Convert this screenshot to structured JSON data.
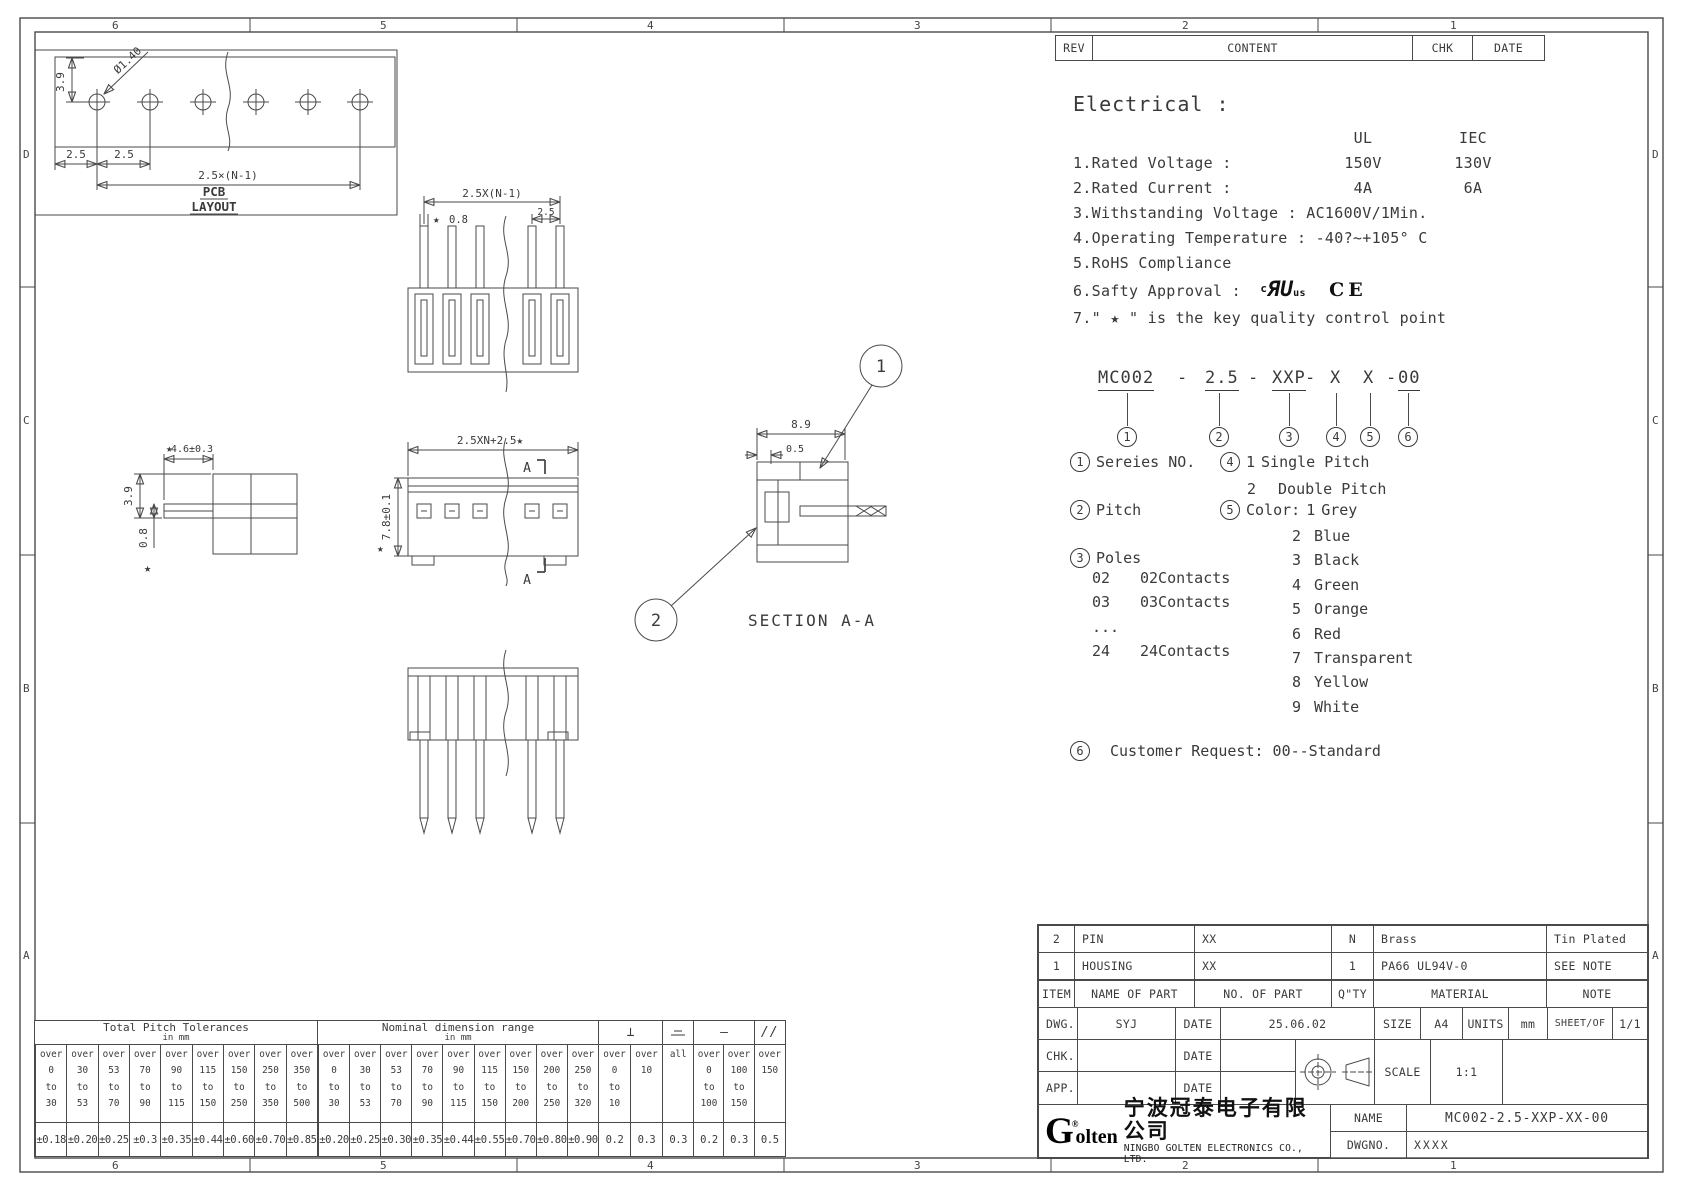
{
  "frame": {
    "zone_cols": [
      "6",
      "5",
      "4",
      "3",
      "2",
      "1"
    ],
    "zone_rows": [
      "D",
      "C",
      "B",
      "A"
    ]
  },
  "rev_table": {
    "rev": "REV",
    "content": "CONTENT",
    "chk": "CHK",
    "date": "DATE"
  },
  "electrical": {
    "heading": "Electrical :",
    "ul": "UL",
    "iec": "IEC",
    "row1_label": "1.Rated Voltage :",
    "row1_ul": "150V",
    "row1_iec": "130V",
    "row2_label": "2.Rated Current :",
    "row2_ul": "4A",
    "row2_iec": "6A",
    "line3": "3.Withstanding Voltage : AC1600V/1Min.",
    "line4": "4.Operating Temperature : -40?~+105° C",
    "line5": "5.RoHS Compliance",
    "line6": "6.Safty Approval :",
    "ul_c": "c",
    "ul_ru": "ЯU",
    "ul_us": "us",
    "ce": "CE",
    "line7": "7.\" ★ \" is the key quality control point"
  },
  "part_number": {
    "p1": "MC002",
    "d1": "-",
    "p2": "2.5",
    "d2": "-",
    "p3": "XXP",
    "d3": "-",
    "p4": "X",
    "p5": "X",
    "d4": "-",
    "p6": "00",
    "circles": [
      "1",
      "2",
      "3",
      "4",
      "5",
      "6"
    ]
  },
  "legend": {
    "series_num": "1",
    "series_label": "Sereies NO.",
    "pitch_num": "2",
    "pitch_label": "Pitch",
    "poles_num": "3",
    "poles_label": "Poles",
    "poles_rows": [
      {
        "code": "02",
        "desc": "02Contacts"
      },
      {
        "code": "03",
        "desc": "03Contacts"
      },
      {
        "code": "...",
        "desc": ""
      },
      {
        "code": "24",
        "desc": "24Contacts"
      }
    ],
    "pitch_type_num": "4",
    "pt_first_code": "1",
    "pt_first_desc": "Single Pitch",
    "pt_rest": [
      {
        "code": "2",
        "desc": "Double Pitch"
      }
    ],
    "color_num": "5",
    "color_label": "Color:",
    "color_first_code": "1",
    "color_first_desc": "Grey",
    "color_rest": [
      {
        "code": "2",
        "desc": "Blue"
      },
      {
        "code": "3",
        "desc": "Black"
      },
      {
        "code": "4",
        "desc": "Green"
      },
      {
        "code": "5",
        "desc": "Orange"
      },
      {
        "code": "6",
        "desc": "Red"
      },
      {
        "code": "7",
        "desc": "Transparent"
      },
      {
        "code": "8",
        "desc": "Yellow"
      },
      {
        "code": "9",
        "desc": "White"
      }
    ],
    "customer_num": "6",
    "customer_label": "Customer Request: 00--Standard"
  },
  "drawings": {
    "pcb": {
      "dim_v": "3.9",
      "dim_dia": "Ø1.40",
      "dim_p1": "2.5",
      "dim_p2": "2.5",
      "dim_total": "2.5×(N-1)",
      "cap1": "PCB",
      "cap2": "LAYOUT"
    },
    "top_view": {
      "star": "★",
      "dim_tab": "0.8",
      "dim_total": "2.5X(N-1)",
      "dim_last": "2.5"
    },
    "side_view": {
      "star": "★",
      "dim_w": "4.6±0.3",
      "dim_h": "3.9",
      "dim_t": "0.8",
      "star2": "★"
    },
    "front_view": {
      "dim_total": "2.5XN+2.5★",
      "sec_a_top": "A",
      "sec_a_bot": "A",
      "dim_h": "7.8±0.1",
      "star": "★"
    },
    "section_view": {
      "dim_w": "8.9",
      "dim_t": "0.5",
      "callout_1": "1",
      "callout_2": "2",
      "caption": "SECTION A-A"
    }
  },
  "pitch_tol_table": {
    "title": "Total Pitch Tolerances",
    "unit": "in mm",
    "cols": [
      {
        "range": "over\n0\nto\n30",
        "val": "±0.18"
      },
      {
        "range": "over\n30\nto\n53",
        "val": "±0.20"
      },
      {
        "range": "over\n53\nto\n70",
        "val": "±0.25"
      },
      {
        "range": "over\n70\nto\n90",
        "val": "±0.3"
      },
      {
        "range": "over\n90\nto\n115",
        "val": "±0.35"
      },
      {
        "range": "over\n115\nto\n150",
        "val": "±0.44"
      },
      {
        "range": "over\n150\nto\n250",
        "val": "±0.60"
      },
      {
        "range": "over\n250\nto\n350",
        "val": "±0.70"
      },
      {
        "range": "over\n350\nto\n500",
        "val": "±0.85"
      }
    ]
  },
  "nominal_tol_table": {
    "title": "Nominal dimension range",
    "unit": "in mm",
    "cols": [
      {
        "range": "over\n0\nto\n30",
        "val": "±0.20"
      },
      {
        "range": "over\n30\nto\n53",
        "val": "±0.25"
      },
      {
        "range": "over\n53\nto\n70",
        "val": "±0.30"
      },
      {
        "range": "over\n70\nto\n90",
        "val": "±0.35"
      },
      {
        "range": "over\n90\nto\n115",
        "val": "±0.44"
      },
      {
        "range": "over\n115\nto\n150",
        "val": "±0.55"
      },
      {
        "range": "over\n150\nto\n200",
        "val": "±0.70"
      },
      {
        "range": "over\n200\nto\n250",
        "val": "±0.80"
      },
      {
        "range": "over\n250\nto\n320",
        "val": "±0.90"
      }
    ]
  },
  "geo_tol_table": {
    "perp_symbol": "⊥",
    "straight_symbol": "—",
    "parallel_symbol": "//",
    "groups": [
      {
        "symbol": "perpendicularity",
        "cols": [
          {
            "range": "over\n0\nto\n10",
            "val": "0.2"
          },
          {
            "range": "over\n10",
            "val": "0.3"
          }
        ]
      },
      {
        "symbol": "symmetry",
        "cols": [
          {
            "range": "all",
            "val": "0.3"
          }
        ]
      },
      {
        "symbol": "straightness",
        "cols": [
          {
            "range": "over\n0\nto\n100",
            "val": "0.2"
          },
          {
            "range": "over\n100\nto\n150",
            "val": "0.3"
          }
        ]
      },
      {
        "symbol": "parallelism",
        "cols": [
          {
            "range": "over\n150",
            "val": "0.5"
          }
        ]
      }
    ]
  },
  "parts_table": {
    "rows": [
      {
        "item": "2",
        "name": "PIN",
        "no": "XX",
        "qty": "N",
        "material": "Brass",
        "note": "Tin Plated"
      },
      {
        "item": "1",
        "name": "HOUSING",
        "no": "XX",
        "qty": "1",
        "material": "PA66 UL94V-0",
        "note": "SEE NOTE"
      }
    ],
    "header": {
      "item": "ITEM",
      "name": "NAME OF PART",
      "no": "NO. OF PART",
      "qty": "Q\"TY",
      "material": "MATERIAL",
      "note": "NOTE"
    }
  },
  "title_block": {
    "dwg_label": "DWG.",
    "dwg_value": "SYJ",
    "date_label_1": "DATE",
    "dwg_date": "25.06.02",
    "chk_label": "CHK.",
    "date_label_2": "DATE",
    "app_label": "APP.",
    "date_label_3": "DATE",
    "size_label": "SIZE",
    "size_value": "A4",
    "units_label": "UNITS",
    "units_value": "mm",
    "sheet_label": "SHEET/OF",
    "sheet_value": "1/1",
    "scale_label": "SCALE",
    "scale_value": "1:1",
    "name_label": "NAME",
    "name_value": "MC002-2.5-XXP-XX-00",
    "dwgno_label": "DWGNO.",
    "dwgno_value": "XXXX"
  },
  "company": {
    "logo_g": "G",
    "logo_rest": "olten",
    "name_cn": "宁波冠泰电子有限公司",
    "name_en": "NINGBO GOLTEN ELECTRONICS CO., LTD."
  }
}
